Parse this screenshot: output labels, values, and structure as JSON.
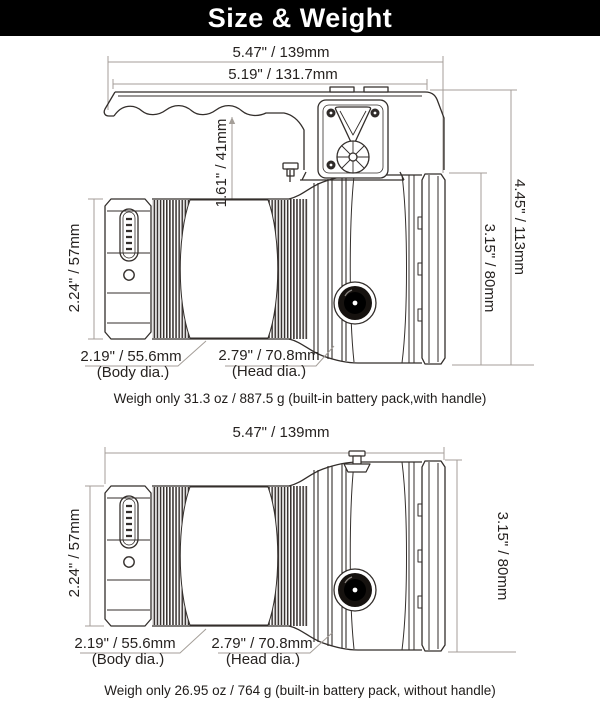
{
  "header": {
    "title": "Size & Weight"
  },
  "colors": {
    "header_bg": "#000000",
    "header_text": "#ffffff",
    "line_art": "#332e2b",
    "dimension_line": "#a49e98",
    "label_text": "#262220"
  },
  "diagram_with_handle": {
    "dimensions": {
      "overall_length": "5.47\" / 139mm",
      "handle_length": "5.19\" / 131.7mm",
      "handle_clearance_height": "1.61\" / 41mm",
      "overall_height": "4.45\" / 113mm",
      "head_height": "3.15\" / 80mm",
      "body_height": "2.24\" / 57mm",
      "body_diameter": "2.19\" / 55.6mm",
      "body_diameter_caption": "(Body dia.)",
      "head_diameter": "2.79\" / 70.8mm",
      "head_diameter_caption": "(Head dia.)"
    },
    "weight_note": "Weigh only 31.3 oz / 887.5 g (built-in battery pack,with handle)"
  },
  "diagram_without_handle": {
    "dimensions": {
      "overall_length": "5.47\" / 139mm",
      "head_height": "3.15\" / 80mm",
      "body_height": "2.24\" / 57mm",
      "body_diameter": "2.19\" / 55.6mm",
      "body_diameter_caption": "(Body dia.)",
      "head_diameter": "2.79\" / 70.8mm",
      "head_diameter_caption": "(Head dia.)"
    },
    "weight_note": "Weigh only 26.95 oz / 764 g (built-in battery pack, without handle)"
  }
}
